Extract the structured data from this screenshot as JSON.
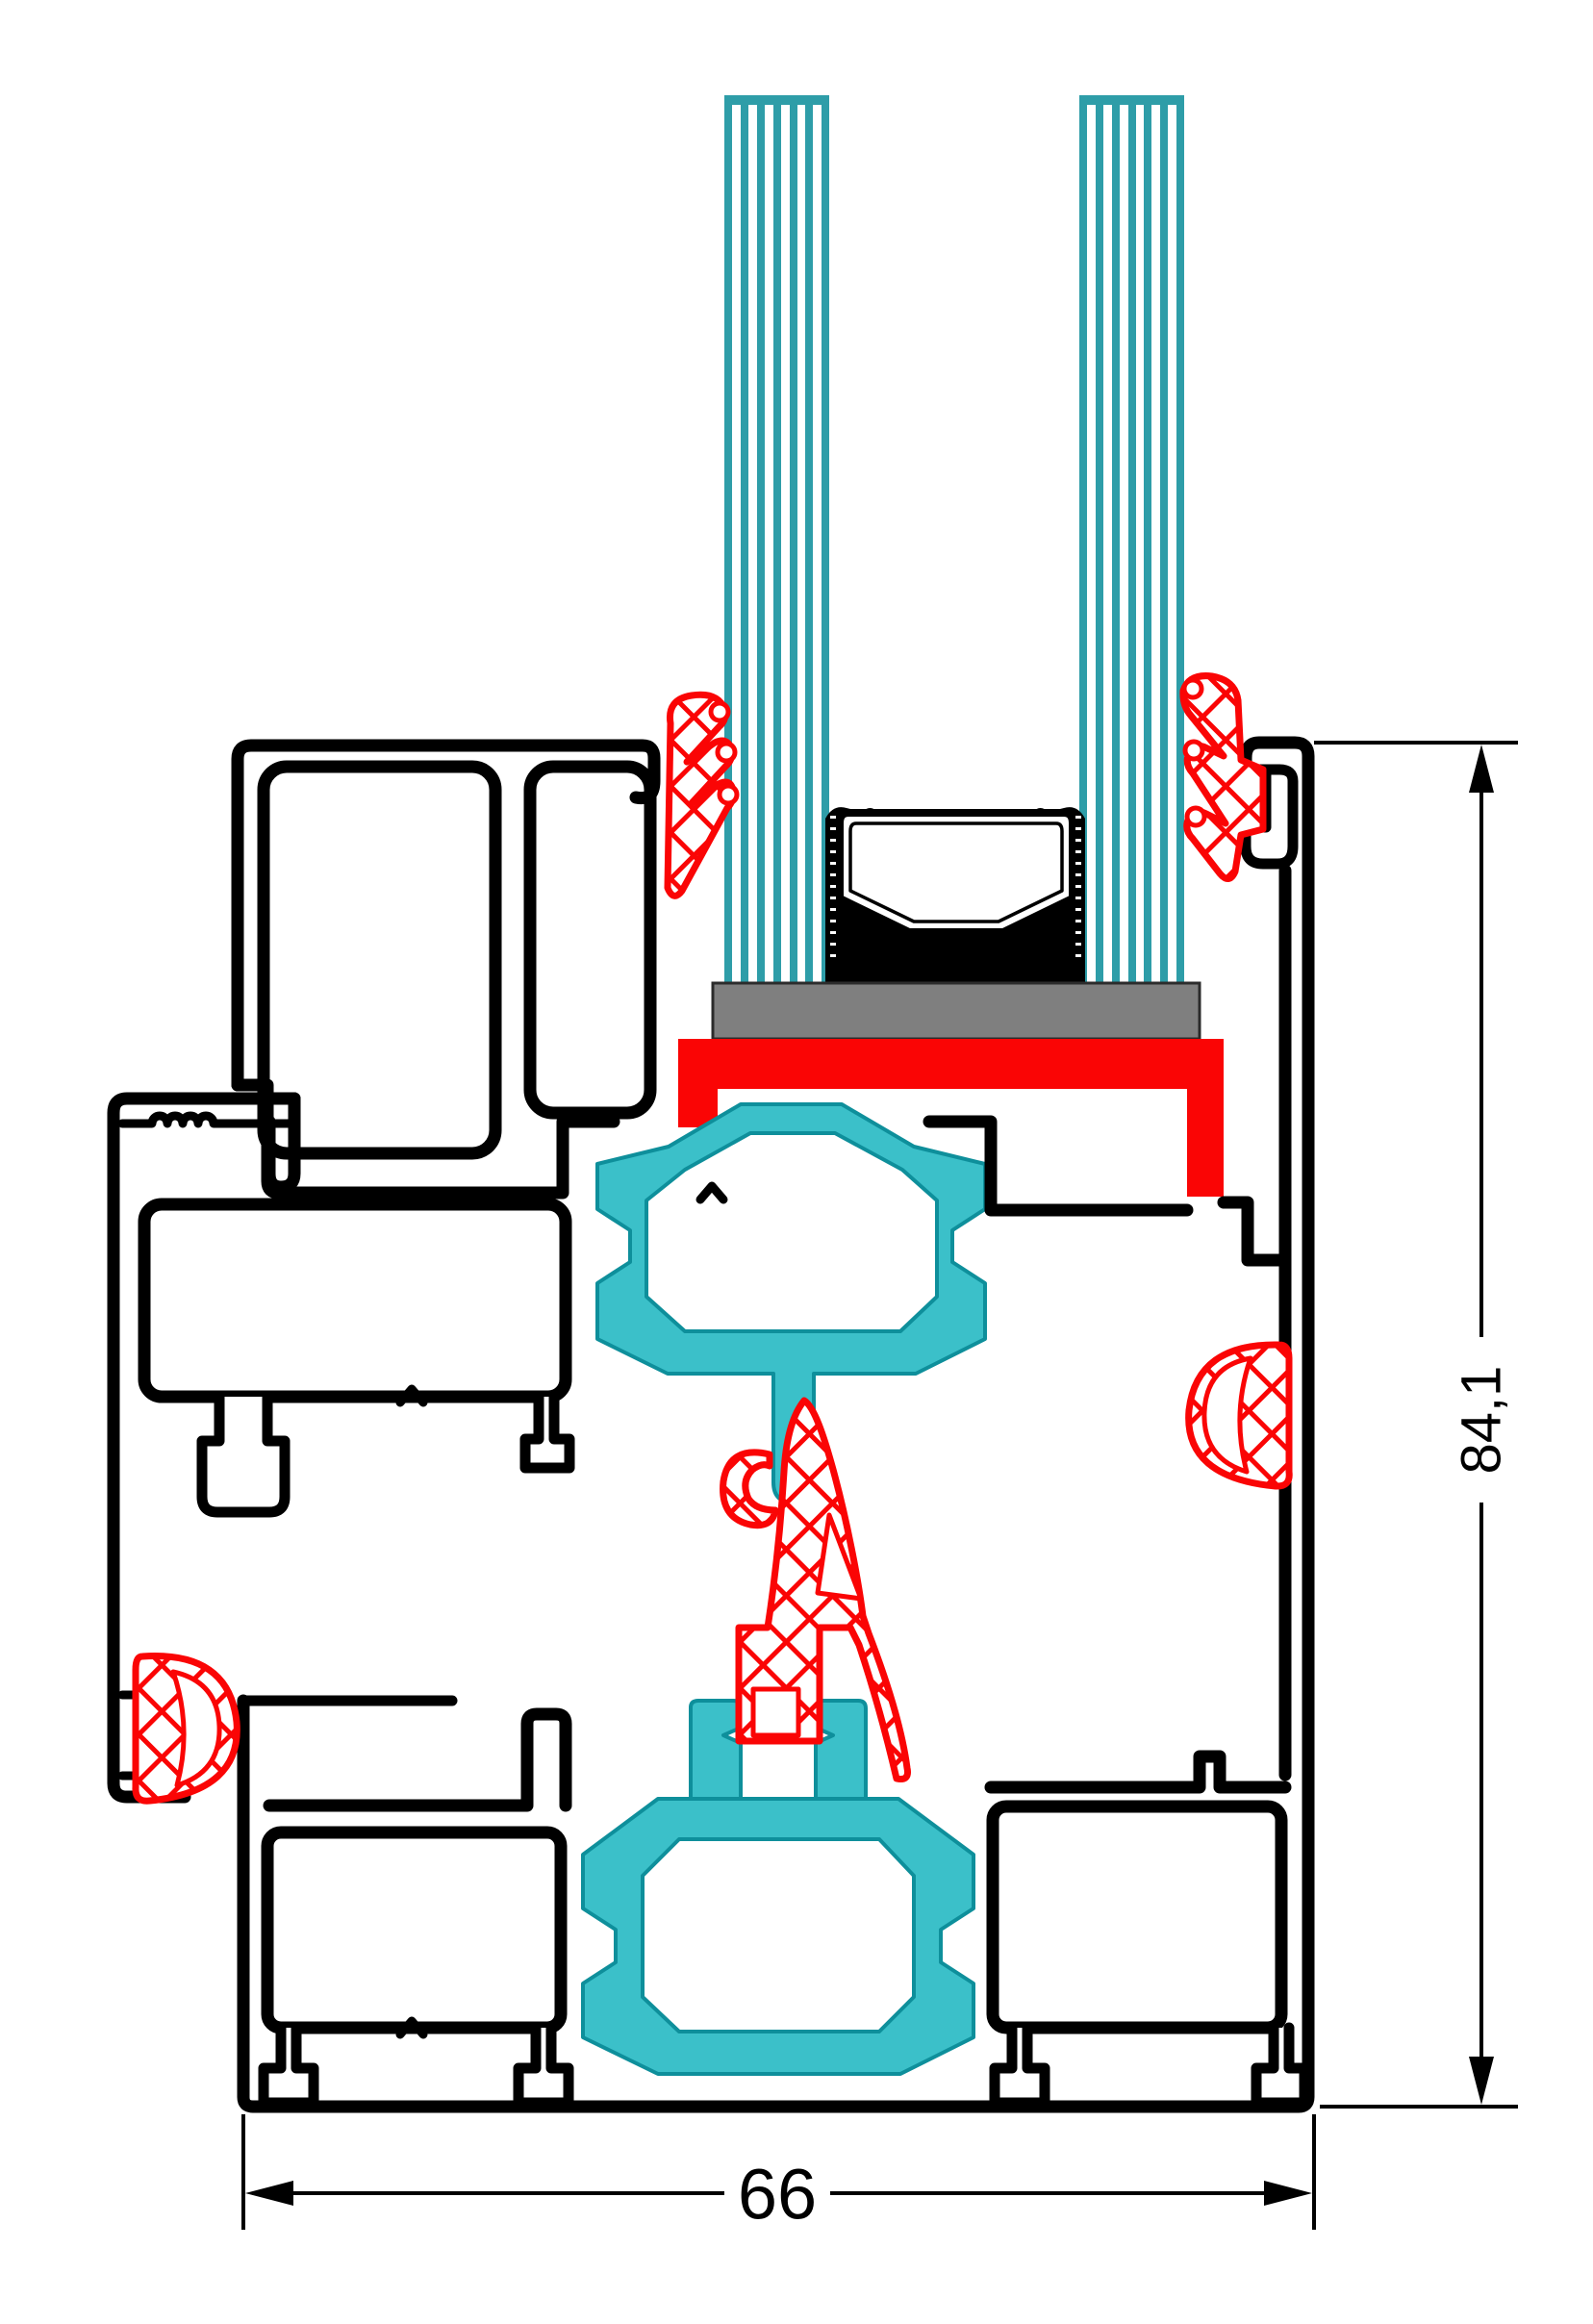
{
  "diagram": {
    "dimensions": {
      "height": "84,1",
      "width": "66"
    },
    "colors": {
      "outline": "#000000",
      "glass_teal": "#2E9DA8",
      "thermal_break_teal": "#3BC0C9",
      "thermal_break_edge": "#0E8F9B",
      "seal_red": "#FA0505",
      "setting_block_gray": "#7F7F7F",
      "background": "#FFFFFF"
    }
  }
}
